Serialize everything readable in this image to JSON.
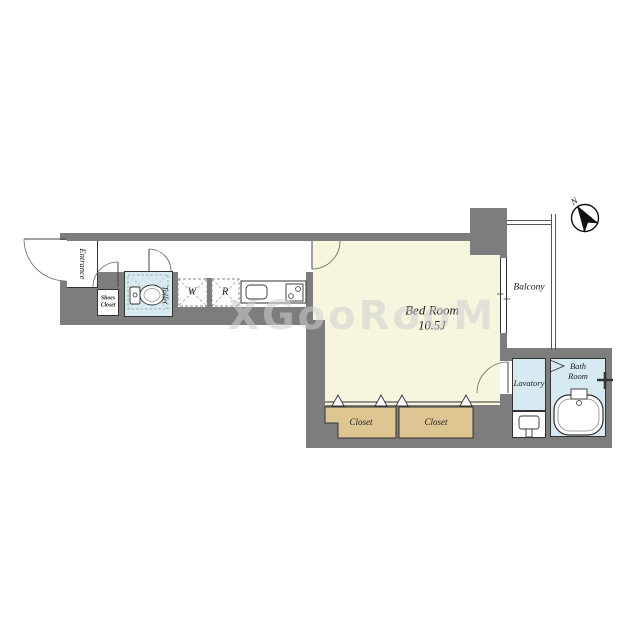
{
  "floorplan": {
    "watermark": "XGooRooM",
    "compass": {
      "north_label": "N"
    },
    "rooms": {
      "entrance": {
        "label": "Entrance"
      },
      "shoes_closet": {
        "label": "Shoes Closet"
      },
      "toilet": {
        "label": "Toilet"
      },
      "washer": {
        "label": "W"
      },
      "refrigerator": {
        "label": "R"
      },
      "bedroom": {
        "label": "Bed Room",
        "size": "10.5J"
      },
      "balcony": {
        "label": "Balcony"
      },
      "closet_left": {
        "label": "Closet"
      },
      "closet_right": {
        "label": "Closet"
      },
      "lavatory": {
        "label": "Lavatory"
      },
      "bathroom": {
        "label": "Bath Room"
      }
    },
    "colors": {
      "wall": "#7d7d7d",
      "bedroom_floor": "#f8f5df",
      "wet_area": "#d8eaf1",
      "closet": "#ddc692",
      "outline": "#333333",
      "watermark": "#cfcfcf"
    }
  }
}
